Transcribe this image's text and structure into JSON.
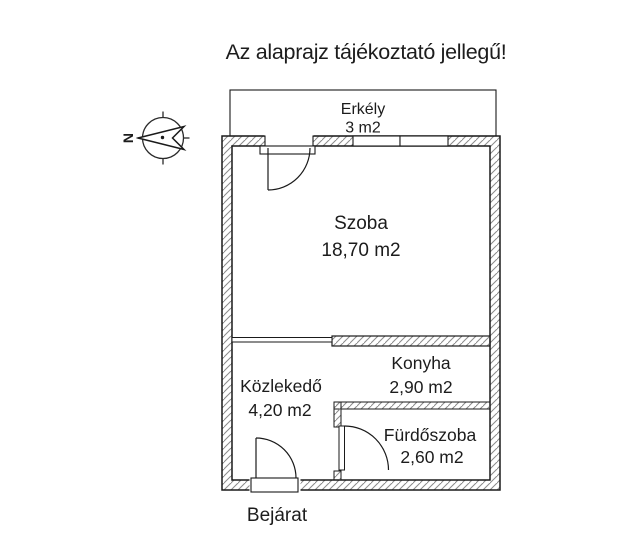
{
  "title": "Az alaprajz tájékoztató jellegű!",
  "compass": {
    "north_label": "N"
  },
  "rooms": {
    "balcony": {
      "name": "Erkély",
      "area": "3 m2"
    },
    "room": {
      "name": "Szoba",
      "area": "18,70 m2"
    },
    "hallway": {
      "name": "Közlekedő",
      "area": "4,20 m2"
    },
    "kitchen": {
      "name": "Konyha",
      "area": "2,90 m2"
    },
    "bathroom": {
      "name": "Fürdőszoba",
      "area": "2,60 m2"
    }
  },
  "entrance_label": "Bejárat",
  "colors": {
    "line": "#1a1a1a",
    "hatch": "#8a8a8a",
    "background": "#ffffff"
  }
}
